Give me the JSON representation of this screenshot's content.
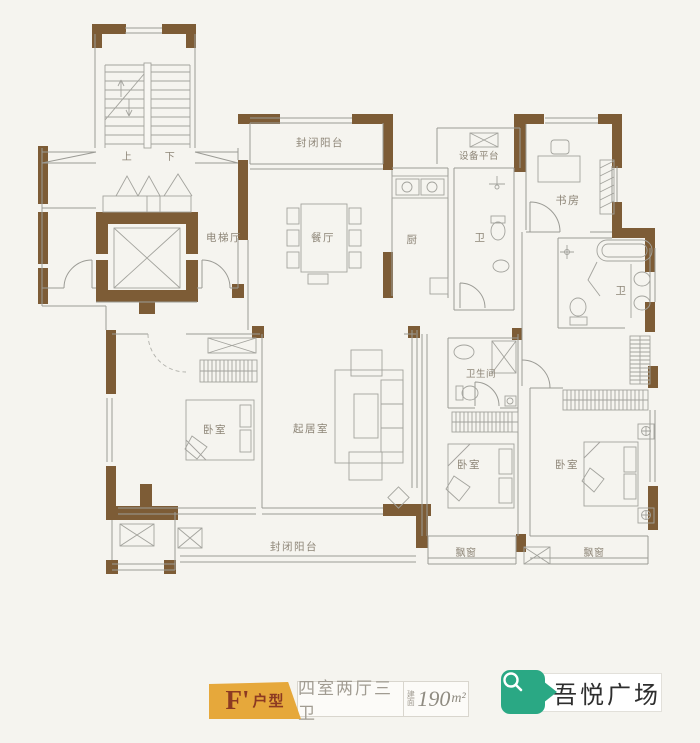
{
  "plan": {
    "labels": {
      "stairs_up": "上",
      "stairs_down": "下",
      "elevator_hall": "电梯厅",
      "balcony_top": "封闭阳台",
      "dining": "餐厅",
      "kitchen": "厨",
      "bath_small": "卫",
      "equipment_platform": "设备平台",
      "study": "书房",
      "bath_master": "卫",
      "bedroom_left": "卧室",
      "living": "起居室",
      "bathroom_mid": "卫生间",
      "bedroom_mid": "卧室",
      "bedroom_right": "卧室",
      "balcony_bottom": "封闭阳台",
      "bay_window_mid": "飘窗",
      "bay_window_right": "飘窗"
    },
    "colors": {
      "wall_brown": "#7d5c36",
      "line_gray": "#9b9b95",
      "label_gray": "#8d8577"
    }
  },
  "legend": {
    "unit_code": "F'",
    "unit_suffix": "户型",
    "layout_spec": "四室两厅三卫",
    "area_prefix": "建面",
    "area_value": "190",
    "area_unit": "m²",
    "colors": {
      "badge_gold": "#e6a83b",
      "badge_text_red": "#8c3a22",
      "spec_text_gray": "#a19c92"
    }
  },
  "brand": {
    "name": "吾悦广场",
    "badge_color": "#2aa884"
  }
}
